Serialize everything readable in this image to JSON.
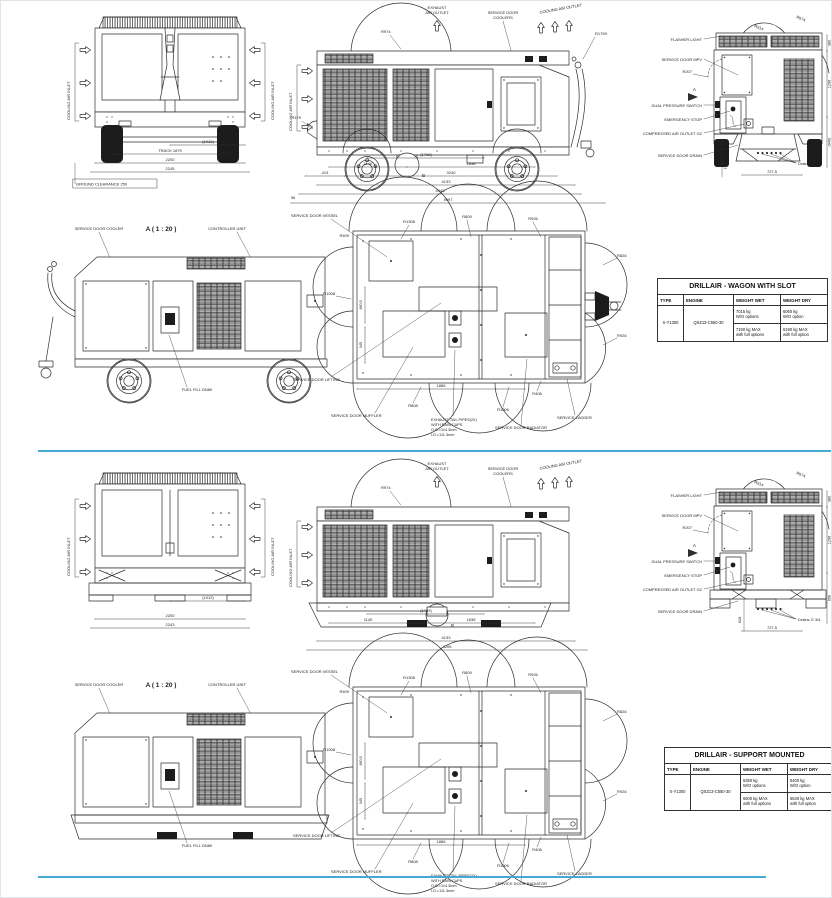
{
  "sheet": {
    "divider_color": "#45aad2"
  },
  "panels": [
    {
      "variant": "wagon",
      "front": {
        "inlet_left": "COOLING AIR INLET",
        "inlet_right": "COOLING AIR INLET",
        "dim_paren": "(1012)",
        "dim_track": "TRACK 1879",
        "dim_inner": "2200",
        "dim_outer": "2245",
        "ground": "GROUND CLEARANCE 250"
      },
      "side": {
        "exhaust1": "EXHAUST",
        "exhaust2": "AIR OUTLET",
        "coolers1": "SERVICE DOOR",
        "coolers2": "COOLERS",
        "cool_out": "COOLING AIR OUTLET",
        "inlet": "COOLING AIR INLET",
        "r_dome": "R974",
        "r_towbar": "R1759",
        "r_front": "R179",
        "b": "B",
        "d_paren": "(1798)",
        "d1": "1140",
        "d2": "1638",
        "d3": "413",
        "d4": "3240",
        "d5": "4133",
        "d6": "4443",
        "d7": "4997",
        "d8": "96",
        "d_total": "4205"
      },
      "rear": {
        "flasher": "FLASHER LIGHT",
        "mpv": "SERVICE DOOR MPV",
        "r207": "R207",
        "a": "A",
        "dps": "DUAL PRESSURE SWITCH",
        "estop": "EMERGENCY STOP",
        "air": "COMPRESSED AIR OUTLET G2",
        "drain": "SERVICE DOOR DRAIN",
        "drains": "Drains G 3/4",
        "r_inner": "R314",
        "r_outer": "R574",
        "d_width": "727,5",
        "d_left": "(1105)",
        "dv1": "380",
        "dv2": "1296",
        "dv3": "2566",
        "dv4": "(940)"
      },
      "detail": {
        "title": "A ( 1 : 20 )",
        "cooler": "SERVICE DOOR COOLER",
        "controller": "CONTROLLER UNIT",
        "fuel": "FUEL FILL DN80"
      },
      "plan": {
        "vessel": "SERVICE DOOR VESSEL",
        "lifting": "SERVICE DOOR LIFTING",
        "muffler": "SERVICE DOOR MUFFLER",
        "radiator": "SERVICE DOOR RADIATOR",
        "ladder": "SERVICE LADDER",
        "ex1": "EXHAUST TAIL PIPES(2X)",
        "ex2": "WITH RAIN CAPS",
        "ex3": "O.D.=114.3mm",
        "ex4": "I.D.=111.3mm",
        "r1": "R1308",
        "r2": "R809",
        "r3": "R926",
        "r4": "R826",
        "r5": "R926",
        "r6": "R409",
        "r7": "R1008",
        "r8": "R808",
        "r9": "R1006",
        "r10": "R408",
        "d1": "1886",
        "d2": "480,5",
        "d3": "345"
      },
      "table": {
        "title": "DRILLAIR - WAGON WITH SLOT",
        "col_type": "TYPE",
        "col_engine": "ENGINE",
        "col_wet": "WEIGHT WET",
        "col_dry": "WEIGHT DRY",
        "type": "X-Y1300",
        "engine": "QSZ13-C550-30",
        "wet_a": "7015 kg",
        "wet_a2": "W/O options",
        "dry_a": "6060 kg",
        "dry_a2": "W/O option",
        "wet_b": "7150 kg MAX",
        "wet_b2": "with full options",
        "dry_b": "6190 kg MAX",
        "dry_b2": "with full option"
      }
    },
    {
      "variant": "support",
      "front": {
        "inlet_left": "COOLING AIR INLET",
        "inlet_right": "COOLING AIR INLET",
        "dim_paren": "(1012)",
        "dim_track": "",
        "dim_inner": "2200",
        "dim_outer": "2243",
        "ground": ""
      },
      "side": {
        "exhaust1": "EXHAUST",
        "exhaust2": "AIR OUTLET",
        "coolers1": "SERVICE DOOR",
        "coolers2": "COOLERS",
        "cool_out": "COOLING AIR OUTLET",
        "inlet": "COOLING AIR INLET",
        "r_dome": "R974",
        "r_towbar": "",
        "r_front": "",
        "b": "B",
        "d_paren": "(1789)",
        "d1": "1140",
        "d2": "1638",
        "d3": "",
        "d4": "",
        "d5": "4133",
        "d6": "",
        "d7": "",
        "d8": "",
        "d_total": "4205"
      },
      "rear": {
        "flasher": "FLASHER LIGHT",
        "mpv": "SERVICE DOOR MPV",
        "r207": "R207",
        "a": "A",
        "dps": "DUAL PRESSURE SWITCH",
        "estop": "EMERGENCY STOP",
        "air": "COMPRESSED AIR OUTLET G2",
        "drain": "SERVICE DOOR DRAIN",
        "drains": "Drains G 3/4",
        "r_inner": "R314",
        "r_outer": "R574",
        "d_width": "727,5",
        "d_left": "628",
        "dv1": "380",
        "dv2": "1296",
        "dv3": "2096",
        "dv4": "650"
      },
      "detail": {
        "title": "A ( 1 : 20 )",
        "cooler": "SERVICE DOOR COOLER",
        "controller": "CONTROLLER UNIT",
        "fuel": "FUEL FILL DN80"
      },
      "plan": {
        "vessel": "SERVICE DOOR VESSEL",
        "lifting": "SERVICE DOOR LIFTING",
        "muffler": "SERVICE DOOR MUFFLER",
        "radiator": "SERVICE DOOR RADIATOR",
        "ladder": "SERVICE LADDER",
        "ex1": "EXHAUST TAIL PIPES(2X)",
        "ex2": "WITH RAIN CAPS",
        "ex3": "O.D.=114.3mm",
        "ex4": "I.D.=111.3mm",
        "r1": "R1308",
        "r2": "R809",
        "r3": "R926",
        "r4": "R826",
        "r5": "R926",
        "r6": "R409",
        "r7": "R1008",
        "r8": "R808",
        "r9": "R1006",
        "r10": "R408",
        "d1": "1886",
        "d2": "480,5",
        "d3": "345"
      },
      "table": {
        "title": "DRILLAIR - SUPPORT MOUNTED",
        "col_type": "TYPE",
        "col_engine": "ENGINE",
        "col_wet": "WEIGHT WET",
        "col_dry": "WEIGHT DRY",
        "type": "X-Y1300",
        "engine": "QSZ13-C550-30",
        "wet_a": "6360 kg",
        "wet_a2": "W/O options",
        "dry_a": "5400 kg",
        "dry_a2": "W/O option",
        "wet_b": "6500 kg MAX",
        "wet_b2": "with full options",
        "dry_b": "5540 kg MAX",
        "dry_b2": "with full option"
      }
    }
  ]
}
